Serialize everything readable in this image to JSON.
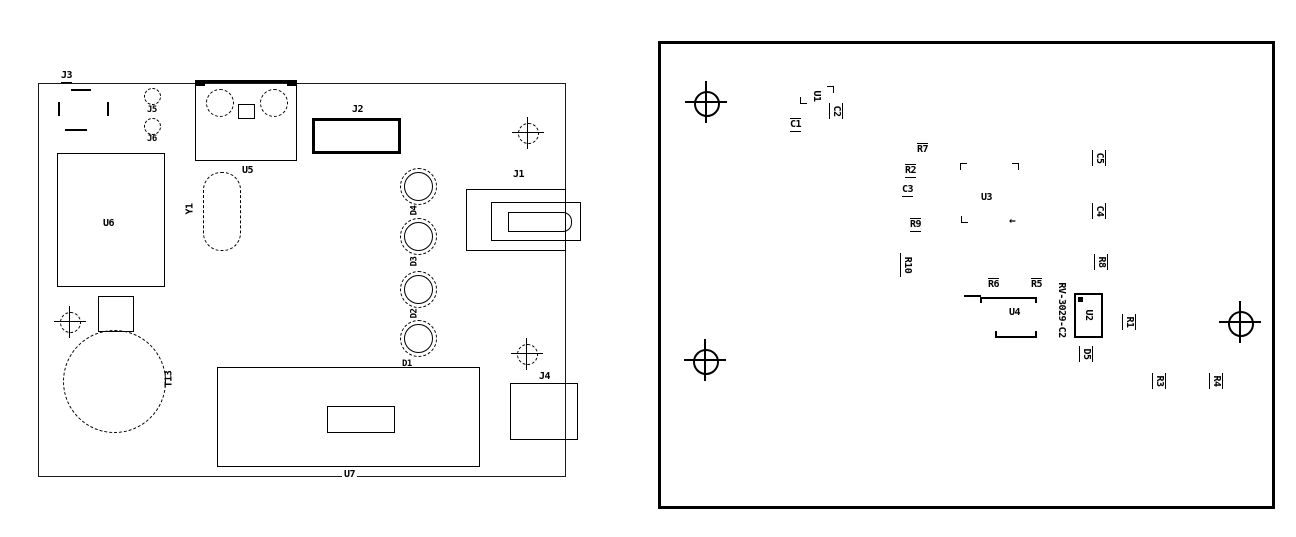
{
  "colors": {
    "line": "#000000",
    "background": "#ffffff"
  },
  "left": {
    "j3": "J3",
    "j5": "J5",
    "j6": "J6",
    "u5": "U5",
    "y1": "Y1",
    "u6": "U6",
    "j2": "J2",
    "j1": "J1",
    "j4": "J4",
    "u7": "U7",
    "t13": "T13",
    "d4": "D4",
    "d3": "D3",
    "d2": "D2",
    "d1": "D1"
  },
  "right": {
    "u1": "U1",
    "c1": "C1",
    "c2": "C2",
    "r7": "R7",
    "r2": "R2",
    "c3": "C3",
    "r9": "R9",
    "u3": "U3",
    "c5": "C5",
    "c4": "C4",
    "r8": "R8",
    "r10": "R10",
    "r6": "R6",
    "r5": "R5",
    "u4": "U4",
    "rtc": "RV-3029-C2",
    "u2": "U2",
    "d5": "D5",
    "r1": "R1",
    "r3": "R3",
    "r4": "R4",
    "u3_arrow": "←"
  }
}
